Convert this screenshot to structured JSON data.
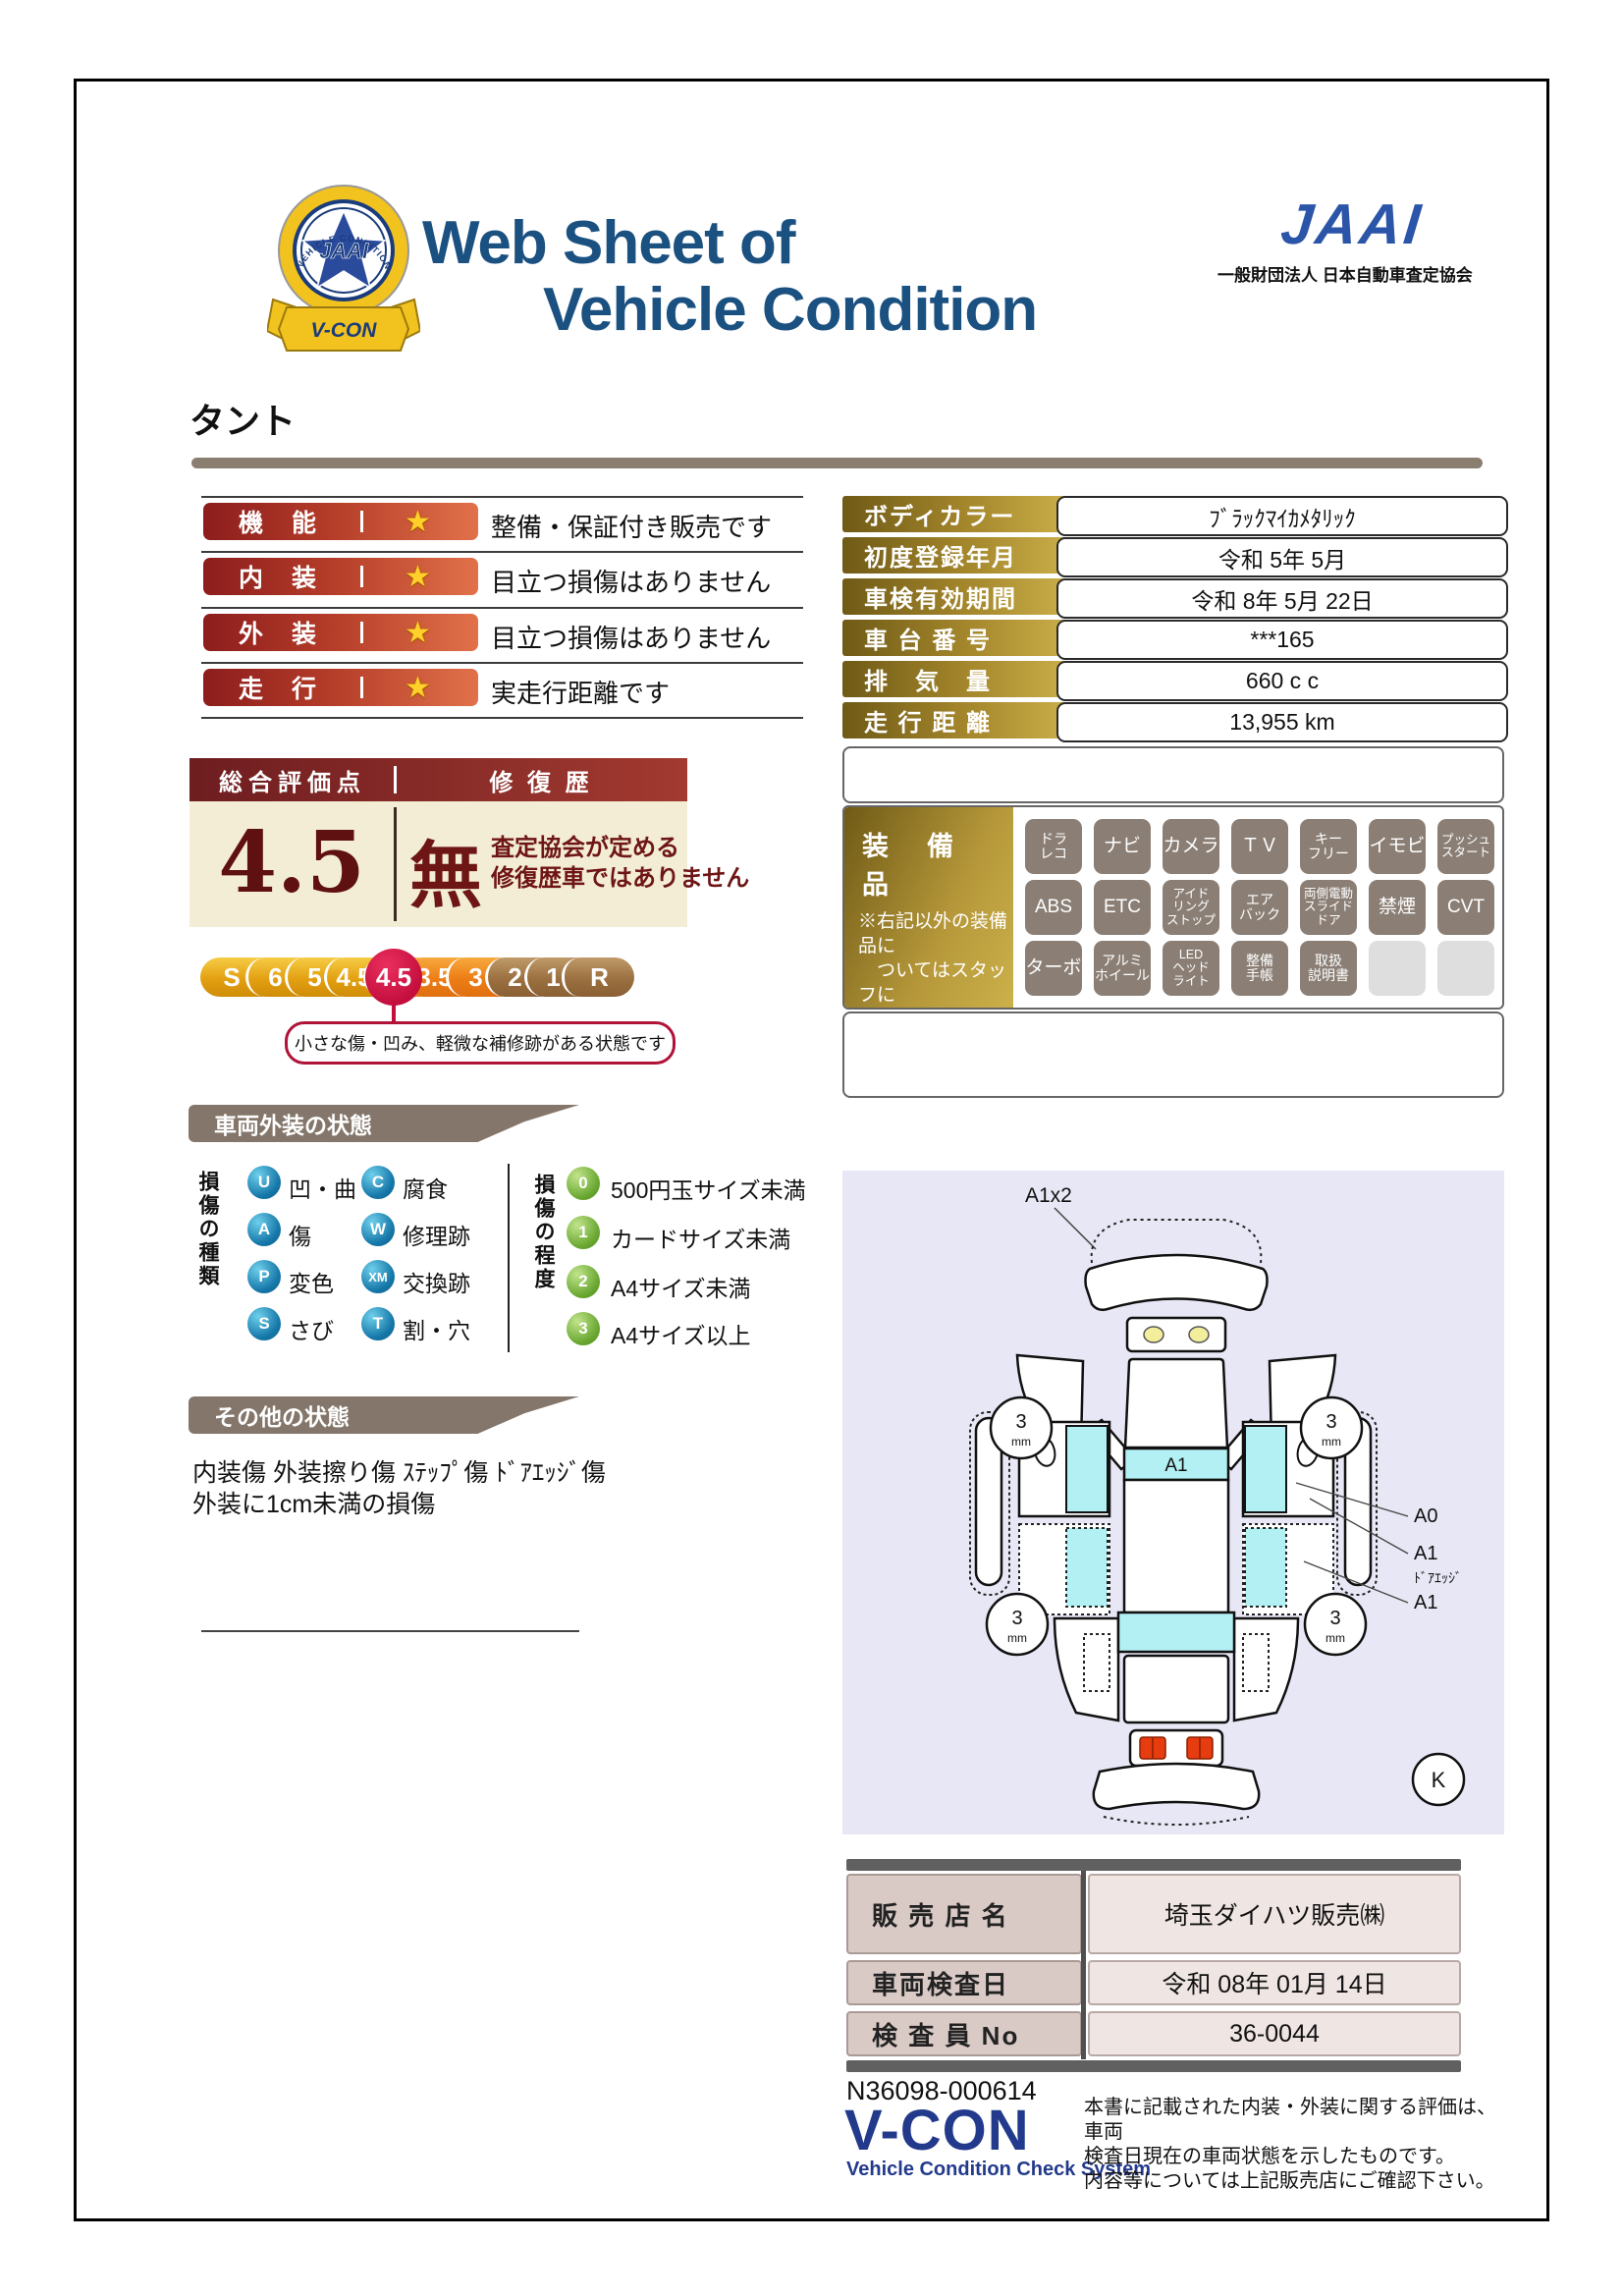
{
  "colors": {
    "title_blue": "#1b5181",
    "jaai_blue": "#2b55a8",
    "gold_dark": "#6f5a16",
    "gold_light": "#cbb04a",
    "bar_red": "#8c1d1d",
    "bar_orange": "#e1714a",
    "maroon": "#6e1515",
    "cream": "#f3edd6",
    "crimson": "#c40f3e",
    "taupe": "#84766a",
    "legend_blue": "#1577a8",
    "legend_green": "#6aa832",
    "badge_gray": "#8b7f75",
    "diagram_bg": "#e7e7f5",
    "panel_cyan": "#b2f0f4",
    "table_pink": "#d9cac6",
    "table_pink_light": "#efe5e3",
    "footer_blue": "#233a8c"
  },
  "header": {
    "badge_ring_text": "VEHICLE CONDITION CHECK SYSTEM",
    "badge_center": "JAAI",
    "badge_ribbon": "V-CON",
    "title_line1": "Web Sheet of",
    "title_line2": "Vehicle Condition",
    "jaai_logo": "JAAI",
    "jaai_subtitle": "一般財団法人 日本自動車査定協会"
  },
  "vehicle_name": "タント",
  "ratings": {
    "star_icon": "★",
    "rows": [
      {
        "label": "機　能",
        "desc": "整備・保証付き販売です"
      },
      {
        "label": "内　装",
        "desc": "目立つ損傷はありません"
      },
      {
        "label": "外　装",
        "desc": "目立つ損傷はありません"
      },
      {
        "label": "走　行",
        "desc": "実走行距離です"
      }
    ]
  },
  "overall": {
    "header_left": "総合評価点",
    "header_right": "修 復 歴",
    "score": "4.5",
    "repair_mark": "無",
    "repair_desc": "査定協会が定める\n修復歴車ではありません",
    "scale": [
      {
        "label": "S"
      },
      {
        "label": "6"
      },
      {
        "label": "5"
      },
      {
        "label": "4.5"
      },
      {
        "label": "4"
      },
      {
        "label": "3.5"
      },
      {
        "label": "3"
      },
      {
        "label": "2"
      },
      {
        "label": "1"
      },
      {
        "label": "R"
      }
    ],
    "selected": "4.5",
    "callout": "小さな傷・凹み、軽微な補修跡がある状態です"
  },
  "info_table": {
    "rows": [
      {
        "label": "ボディカラー",
        "value": "ﾌﾞﾗｯｸﾏｲｶﾒﾀﾘｯｸ"
      },
      {
        "label": "初度登録年月",
        "value": "令和 5年 5月"
      },
      {
        "label": "車検有効期間",
        "value": "令和 8年 5月 22日"
      },
      {
        "label": "車 台 番 号",
        "value": "***165"
      },
      {
        "label": "排　気　量",
        "value": "660 c c"
      },
      {
        "label": "走 行 距 離",
        "value": "13,955 km"
      }
    ]
  },
  "equipment": {
    "title": "装　備　品",
    "note": "※右記以外の装備品に\n　ついてはスタッフに\n　お尋ねください。",
    "badges": [
      {
        "label": "ドラ\nレコ"
      },
      {
        "label": "ナビ"
      },
      {
        "label": "カメラ"
      },
      {
        "label": "ＴＶ"
      },
      {
        "label": "キー\nフリー"
      },
      {
        "label": "イモビ"
      },
      {
        "label": "プッシュ\nスタート"
      },
      {
        "label": "ABS"
      },
      {
        "label": "ETC"
      },
      {
        "label": "アイド\nリング\nストップ"
      },
      {
        "label": "エア\nバック"
      },
      {
        "label": "両側電動\nスライド\nドア"
      },
      {
        "label": "禁煙"
      },
      {
        "label": "CVT"
      },
      {
        "label": "ターボ"
      },
      {
        "label": "アルミ\nホイール"
      },
      {
        "label": "LED\nヘッド\nライト"
      },
      {
        "label": "整備\n手帳"
      },
      {
        "label": "取扱\n説明書"
      },
      {
        "label": ""
      },
      {
        "label": ""
      }
    ]
  },
  "exterior": {
    "section_title": "車両外装の状態",
    "kind_label": "損傷の種類",
    "kinds": [
      {
        "code": "U",
        "text": "凹・曲"
      },
      {
        "code": "C",
        "text": "腐食"
      },
      {
        "code": "A",
        "text": "傷"
      },
      {
        "code": "W",
        "text": "修理跡"
      },
      {
        "code": "P",
        "text": "変色"
      },
      {
        "code": "XM",
        "text": "交換跡"
      },
      {
        "code": "S",
        "text": "さび"
      },
      {
        "code": "T",
        "text": "割・穴"
      }
    ],
    "degree_label": "損傷の程度",
    "degrees": [
      {
        "code": "0",
        "text": "500円玉サイズ未満"
      },
      {
        "code": "1",
        "text": "カードサイズ未満"
      },
      {
        "code": "2",
        "text": "A4サイズ未満"
      },
      {
        "code": "3",
        "text": "A4サイズ以上"
      }
    ]
  },
  "other": {
    "section_title": "その他の状態",
    "text": "内装傷 外装擦り傷 ｽﾃｯﾌﾟ傷 ﾄﾞｱｴｯｼﾞ傷\n外装に1cm未満の損傷"
  },
  "diagram": {
    "front_label": "A1x2",
    "roof_label": "A1",
    "label_a0": "A0",
    "label_a1_top": "A1",
    "label_dooredge": "ﾄﾞｱｴｯｼﾞ",
    "label_a1_bottom": "A1",
    "tread_value": "3",
    "tread_unit": "mm",
    "corner_mark": "K"
  },
  "dealer_table": {
    "rows": [
      {
        "label": "販 売 店 名",
        "value": "埼玉ダイハツ販売㈱"
      },
      {
        "label": "車両検査日",
        "value": "令和 08年 01月 14日"
      },
      {
        "label": "検 査 員 No",
        "value": "36-0044"
      }
    ]
  },
  "footer": {
    "code": "N36098-000614",
    "vcon": "V-CON",
    "vcon_sub": "Vehicle Condition Check System",
    "disclaimer": "本書に記載された内装・外装に関する評価は、車両\n検査日現在の車両状態を示したものです。\n内容等については上記販売店にご確認下さい。"
  }
}
